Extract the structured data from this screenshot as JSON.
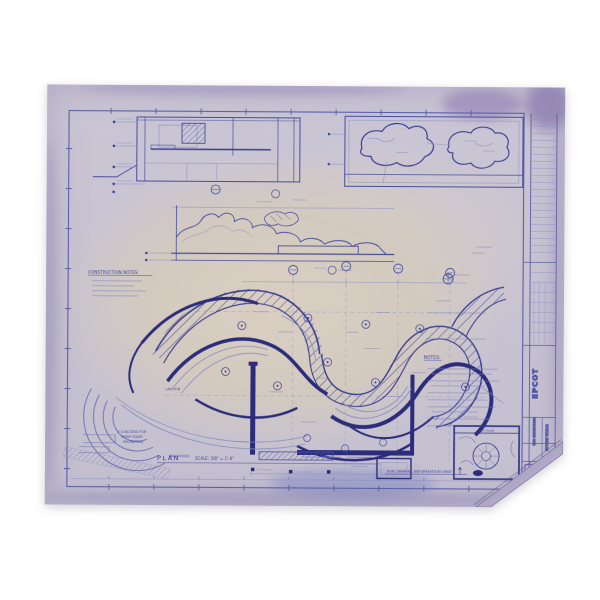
{
  "photo": {
    "background": "#ffffff"
  },
  "sheet": {
    "kind": "aged blueprint drawing, blue ink on faded lavender-tan paper",
    "colors": {
      "paper_edge": "#c7c2d2",
      "paper_center": "#d9cec0",
      "ink": "#474da0",
      "ink_dark": "#2b2d7c",
      "ink_light": "#8a8fc4",
      "stain_purple": "#7d6fa6",
      "smudge_blue": "#4a5ab4"
    }
  },
  "labels": {
    "construction_notes_heading": "CONSTRUCTION NOTES:",
    "plan": "PLAN",
    "plan_scale": "SCALE: 3/8\" = 1'-0\"",
    "graphic_note": "FOR GRAPHIC INFORMATION ONLY",
    "notes_heading": "NOTES:",
    "key_plan": "KEY PLAN",
    "access_note": [
      "2'-0 ACCESS FOR",
      "HEAVY EQUIP.",
      "EXCAVATION"
    ],
    "lagoon": "LAGOON",
    "balsa": "BALSA ROCK"
  },
  "title_block": {
    "project": "EPCOT",
    "division": "FUTURE WORLD",
    "company": "WED ENTERPRISES",
    "drawing_number": "1-0-61"
  }
}
